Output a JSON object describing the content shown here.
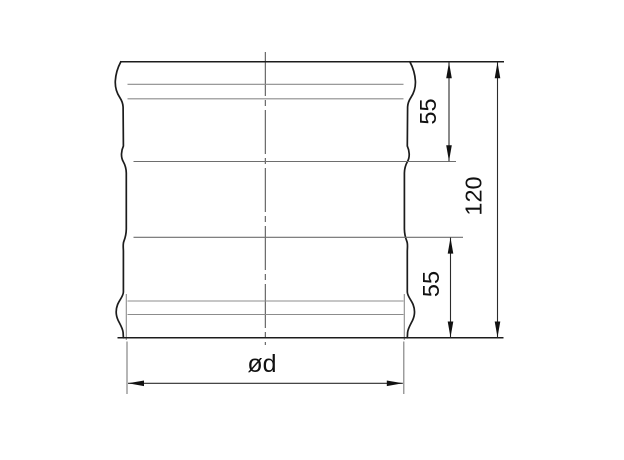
{
  "drawing": {
    "dimensions": {
      "top_section": "55",
      "bottom_section": "55",
      "total_height": "120",
      "diameter": "ød"
    },
    "colors": {
      "outline": "#1c1c1c",
      "thin_line": "#8c8c8c",
      "inner_line": "#6e6e6e",
      "dimension_line": "#2b2b2b",
      "text": "#111111",
      "background": "#ffffff"
    }
  }
}
